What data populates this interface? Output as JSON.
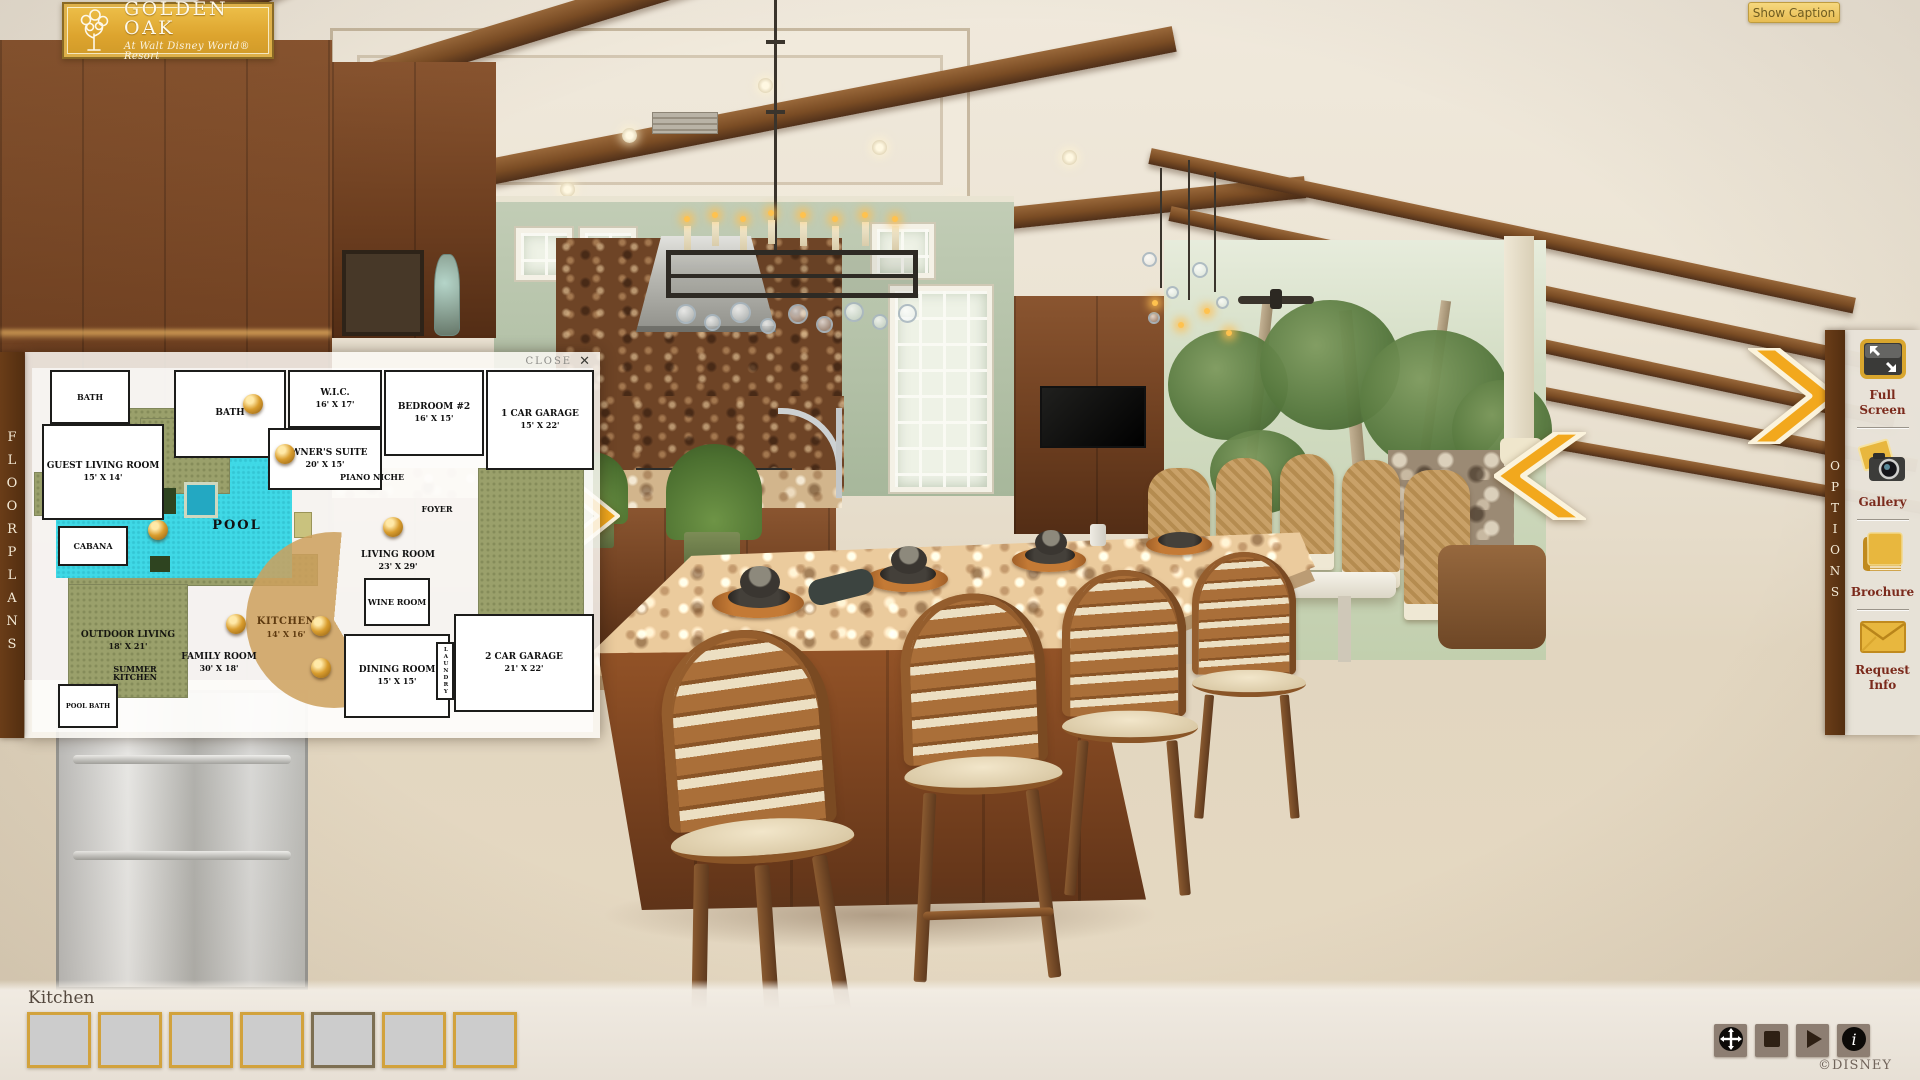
{
  "logo": {
    "title": "GOLDEN OAK",
    "subtitle": "At Walt Disney World® Resort",
    "icon": "oak-tree-icon"
  },
  "top_bar": {
    "show_caption_label": "Show Caption"
  },
  "left_tab": {
    "label": "FLOORPLANS"
  },
  "right_tab": {
    "label": "OPTIONS"
  },
  "options_panel": {
    "items": [
      {
        "id": "fullscreen",
        "label": "Full Screen",
        "icon": "fullscreen-icon"
      },
      {
        "id": "gallery",
        "label": "Gallery",
        "icon": "camera-icon"
      },
      {
        "id": "brochure",
        "label": "Brochure",
        "icon": "book-icon"
      },
      {
        "id": "request-info",
        "label": "Request Info",
        "icon": "envelope-icon"
      }
    ]
  },
  "floorplan": {
    "close_label": "CLOSE",
    "close_icon": "✕",
    "rooms": [
      {
        "id": "bath1",
        "name": "BATH",
        "dims": ""
      },
      {
        "id": "guest-living",
        "name": "GUEST LIVING ROOM",
        "dims": "15' X 14'"
      },
      {
        "id": "bath2",
        "name": "BATH",
        "dims": ""
      },
      {
        "id": "wic",
        "name": "W.I.C.",
        "dims": "16' X 17'"
      },
      {
        "id": "bedroom2",
        "name": "BEDROOM #2",
        "dims": "16' X 15'"
      },
      {
        "id": "garage1",
        "name": "1 CAR GARAGE",
        "dims": "15' X 22'"
      },
      {
        "id": "owners-suite",
        "name": "OWNER'S SUITE",
        "dims": "20' X 15'"
      },
      {
        "id": "piano-niche",
        "name": "PIANO NICHE",
        "dims": ""
      },
      {
        "id": "foyer",
        "name": "FOYER",
        "dims": ""
      },
      {
        "id": "living-room",
        "name": "LIVING ROOM",
        "dims": "23' X 29'"
      },
      {
        "id": "wine-room",
        "name": "WINE ROOM",
        "dims": ""
      },
      {
        "id": "pool",
        "name": "POOL",
        "dims": ""
      },
      {
        "id": "cabana",
        "name": "CABANA",
        "dims": ""
      },
      {
        "id": "outdoor-living",
        "name": "OUTDOOR LIVING",
        "dims": "18' X 21'"
      },
      {
        "id": "summer-kitchen",
        "name": "SUMMER KITCHEN",
        "dims": ""
      },
      {
        "id": "pool-bath",
        "name": "POOL BATH",
        "dims": ""
      },
      {
        "id": "family-room",
        "name": "FAMILY ROOM",
        "dims": "30' X 18'"
      },
      {
        "id": "kitchen",
        "name": "KITCHEN",
        "dims": "14' X 16'"
      },
      {
        "id": "dining-room",
        "name": "DINING ROOM",
        "dims": "15' X 15'"
      },
      {
        "id": "garage2",
        "name": "2 CAR GARAGE",
        "dims": "21' X 22'"
      },
      {
        "id": "laundry",
        "name": "LAUNDRY",
        "dims": ""
      }
    ],
    "markers": [
      {
        "id": "viewpoint-owners-bath"
      },
      {
        "id": "viewpoint-owners-suite"
      },
      {
        "id": "viewpoint-pool"
      },
      {
        "id": "viewpoint-living-room"
      },
      {
        "id": "viewpoint-family-room"
      },
      {
        "id": "viewpoint-kitchen"
      },
      {
        "id": "viewpoint-breakfast"
      }
    ]
  },
  "caption": {
    "text": "Kitchen"
  },
  "thumbnails": [
    {
      "id": "thumb-1",
      "scene": "living-room-pool-view",
      "selected": false
    },
    {
      "id": "thumb-2",
      "scene": "foyer-entry",
      "selected": false
    },
    {
      "id": "thumb-3",
      "scene": "bath-vanity",
      "selected": false
    },
    {
      "id": "thumb-4",
      "scene": "courtyard-pool",
      "selected": false
    },
    {
      "id": "thumb-5",
      "scene": "kitchen-island",
      "selected": true
    },
    {
      "id": "thumb-6",
      "scene": "great-room",
      "selected": false
    },
    {
      "id": "thumb-7",
      "scene": "family-room-media",
      "selected": false
    }
  ],
  "player": {
    "buttons": [
      {
        "id": "pan",
        "icon": "pan-arrows-icon"
      },
      {
        "id": "stop",
        "icon": "stop-icon"
      },
      {
        "id": "play",
        "icon": "play-icon"
      },
      {
        "id": "info",
        "icon": "info-icon"
      }
    ]
  },
  "footer": {
    "copyright": "©DISNEY"
  },
  "colors": {
    "brand_gold": "#D9A62E",
    "arrow_gold": "#F2A81D",
    "tab_brown": "#5C3513",
    "label_maroon": "#7B2A1C",
    "pool_cyan": "#3FD9E6",
    "panel_beige": "#E7E2D8"
  }
}
